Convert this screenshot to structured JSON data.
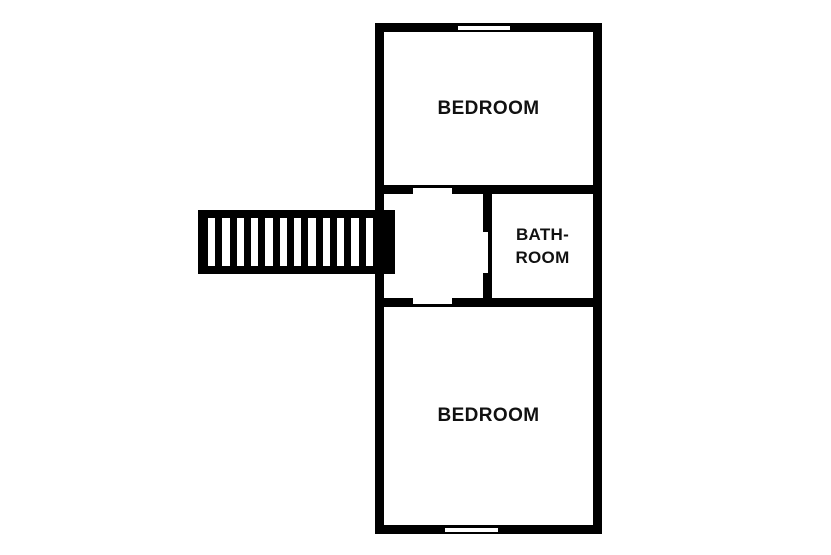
{
  "plan": {
    "rooms": [
      {
        "id": "bedroom-top",
        "label": "BEDROOM"
      },
      {
        "id": "bathroom",
        "label_line1": "BATH-",
        "label_line2": "ROOM"
      },
      {
        "id": "bedroom-bottom",
        "label": "BEDROOM"
      }
    ],
    "stairs": {
      "steps": 12
    },
    "colors": {
      "wall": "#000000",
      "background": "#ffffff",
      "text": "#111111"
    }
  }
}
